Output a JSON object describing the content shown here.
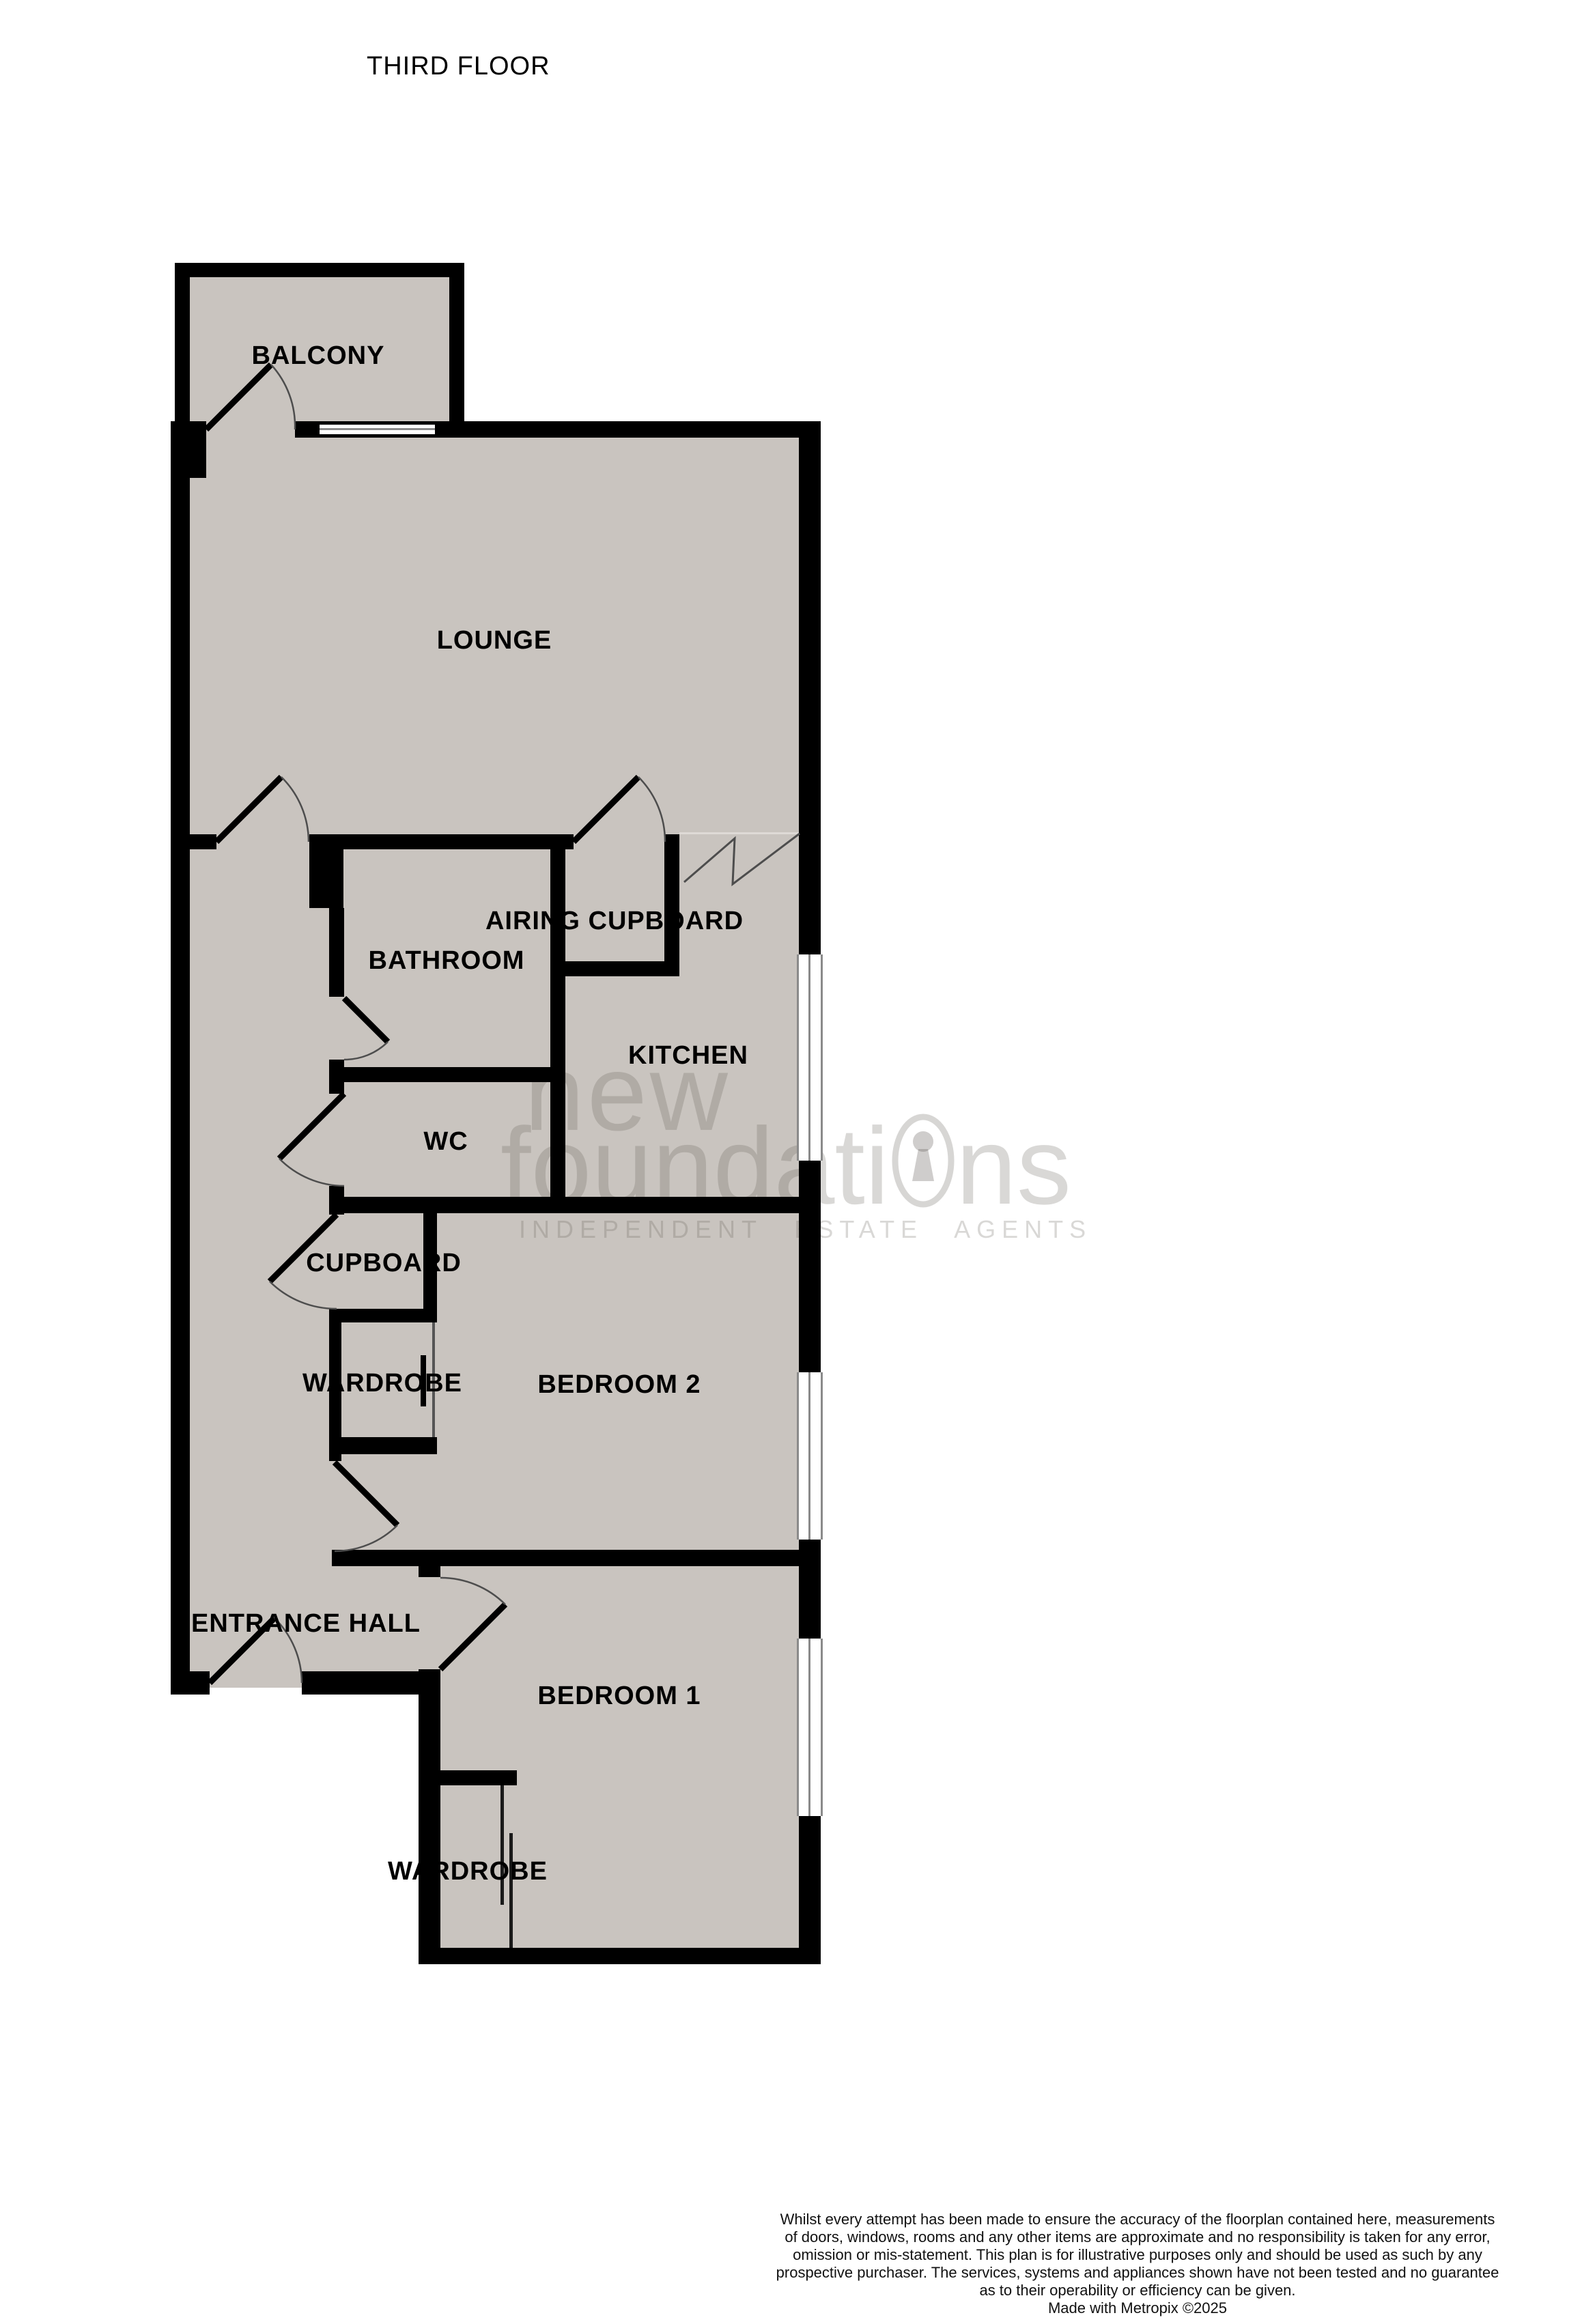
{
  "title": "THIRD FLOOR",
  "rooms": [
    {
      "id": "balcony",
      "label": "BALCONY"
    },
    {
      "id": "lounge",
      "label": "LOUNGE"
    },
    {
      "id": "airing-cupboard",
      "label": "AIRING CUPBOARD"
    },
    {
      "id": "bathroom",
      "label": "BATHROOM"
    },
    {
      "id": "kitchen",
      "label": "KITCHEN"
    },
    {
      "id": "wc",
      "label": "WC"
    },
    {
      "id": "cupboard",
      "label": "CUPBOARD"
    },
    {
      "id": "wardrobe-bedroom2",
      "label": "WARDROBE"
    },
    {
      "id": "bedroom2",
      "label": "BEDROOM 2"
    },
    {
      "id": "entrance-hall",
      "label": "ENTRANCE HALL"
    },
    {
      "id": "bedroom1",
      "label": "BEDROOM 1"
    },
    {
      "id": "wardrobe-bedroom1",
      "label": "WARDROBE"
    }
  ],
  "watermark": {
    "word1": "new",
    "word2": "foundations",
    "word2_display": {
      "before_keyhole": "foundati",
      "after_keyhole": "ns"
    },
    "tagline": "INDEPENDENT ESTATE AGENTS",
    "keyhole_icon": "keyhole-in-oval"
  },
  "disclaimer": {
    "lines": [
      "Whilst every attempt has been made to ensure the accuracy of the floorplan contained here, measurements",
      "of doors, windows, rooms and any other items are approximate and no responsibility is taken for any error,",
      "omission or mis-statement. This plan is for illustrative purposes only and should be used as such by any",
      "prospective purchaser. The services, systems and appliances shown have not been tested and no guarantee",
      "as to their operability or efficiency can be given."
    ],
    "credit": "Made with Metropix ©2025"
  },
  "colors": {
    "floor": "#c9c4bf",
    "wall": "#000000",
    "door_arc": "#4d4d4d",
    "window_line": "#8a8a8a",
    "watermark": "rgba(95,90,85,0.24)",
    "background": "#ffffff"
  }
}
